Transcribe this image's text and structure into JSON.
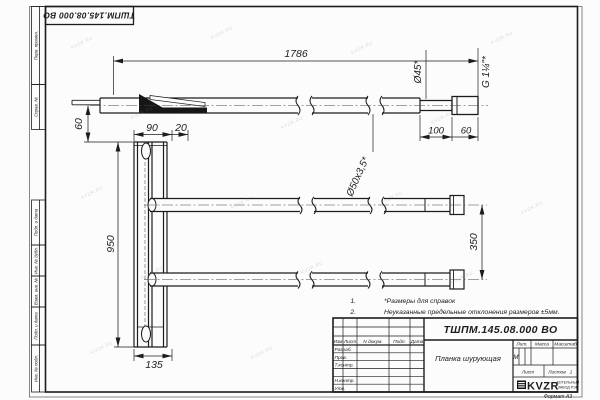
{
  "sheet": {
    "doc_number": "ТШПМ.145.08.000 ВО",
    "format_label": "Формат А3",
    "watermark": "KVZR.RU"
  },
  "dims": {
    "length_1786": "1786",
    "height_60_left": "60",
    "width_90": "90",
    "width_20": "20",
    "height_950": "950",
    "width_135": "135",
    "spacing_350": "350",
    "length_100": "100",
    "length_60_right": "60"
  },
  "labels": {
    "dia45": "Ø45*",
    "thread": "G 1¼\"*",
    "dia50": "Ø50х3,5*"
  },
  "notes": {
    "n1_num": "1.",
    "n1_text": "*Размеры для справок",
    "n2_num": "2.",
    "n2_text": "Неуказанные предельные отклонения размеров ±5мм."
  },
  "margin_labels": [
    "Перв. примен.",
    "Справ. №",
    "Подп. и дата",
    "Инв. № дубл.",
    "Взам. инв. №",
    "Подп. и дата",
    "Инв. № подл."
  ],
  "title_block": {
    "designation": "ТШПМ.145.08.000 ВО",
    "part_name": "Планка шурующая",
    "cols": {
      "izm": "Изм",
      "list": "Лист",
      "ndoc": "N докум.",
      "podp": "Подп.",
      "data": "Дата"
    },
    "rows": {
      "razrab": "Разраб.",
      "prov": "Пров.",
      "tkontr": "Т.контр.",
      "nkontr": "Н.контр.",
      "utv": "Утв."
    },
    "lit_label": "Лит.",
    "lit_value": "М",
    "massa_label": "Масса",
    "masshtab_label": "Масштаб",
    "list_label": "Лист",
    "listov_label": "Листов",
    "listov_value": "1",
    "logo_text": "KVZR",
    "org_line1": "КОТЕЛЬНЫЙ",
    "org_line2": "ЗАВОД РЭП"
  }
}
